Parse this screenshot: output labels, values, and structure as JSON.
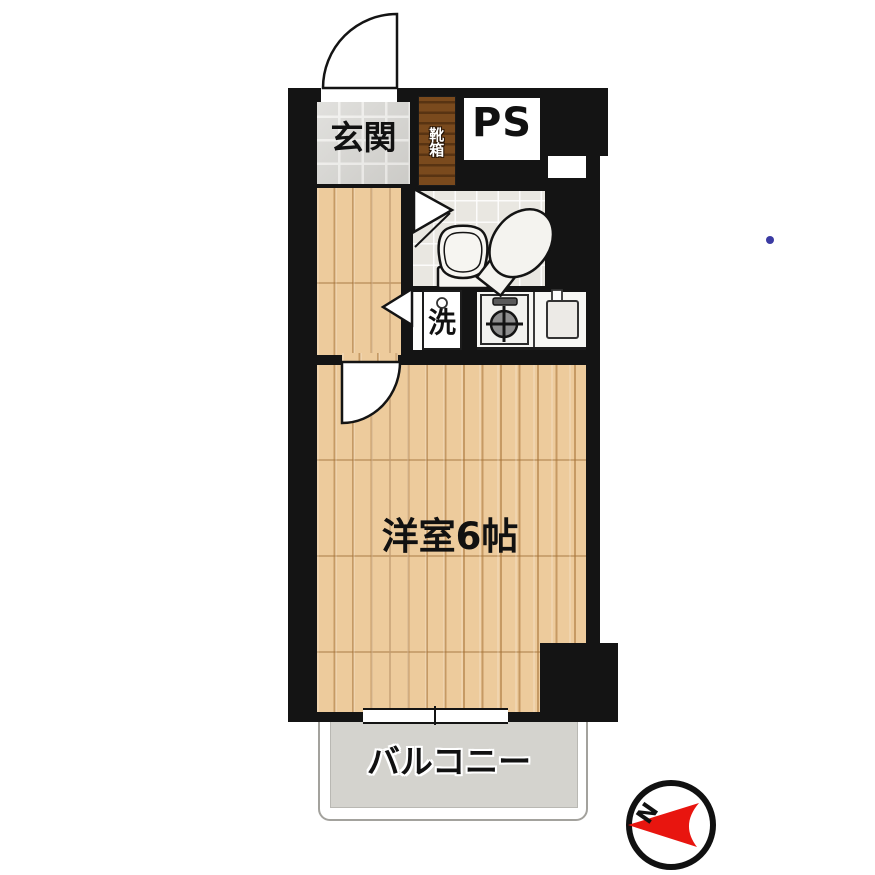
{
  "rooms": {
    "entrance_label": "玄関",
    "shoe_box_label": "靴箱",
    "pipe_space_label": "PS",
    "laundry_label": "洗",
    "main_room_label": "洋室6帖",
    "balcony_label": "バルコニー"
  },
  "compass": {
    "north_label": "N"
  },
  "colors": {
    "wall": "#141414",
    "wood_floor": "#edcb9c",
    "entrance_tile": "#d6d5d1",
    "bathroom_tile": "#e9e7e1",
    "shoe_box": "#7a4a1d",
    "balcony_floor": "#d4d3ce",
    "compass_red": "#e8150f",
    "marker_blue": "#3b3ba3"
  }
}
